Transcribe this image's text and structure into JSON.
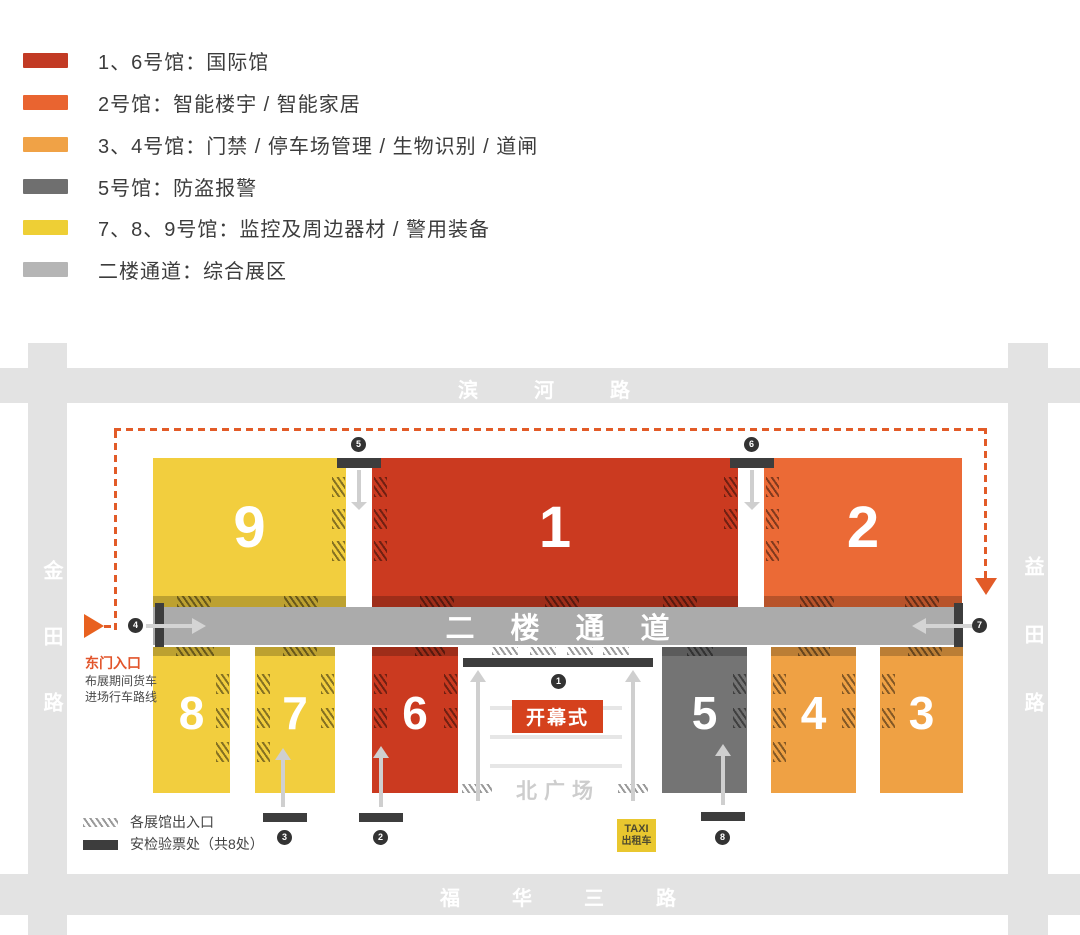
{
  "legend": {
    "items": [
      {
        "label": "1、6号馆：国际馆",
        "color": "#c23a24"
      },
      {
        "label": "2号馆：智能楼宇 / 智能家居",
        "color": "#e96430"
      },
      {
        "label": "3、4号馆：门禁 / 停车场管理 / 生物识别 / 道闸",
        "color": "#f0a246"
      },
      {
        "label": "5号馆：防盗报警",
        "color": "#6f6f6f"
      },
      {
        "label": "7、8、9号馆：监控及周边器材 / 警用装备",
        "color": "#eecf35"
      },
      {
        "label": "二楼通道：综合展区",
        "color": "#b5b5b5"
      }
    ]
  },
  "map": {
    "roads": {
      "top": "滨河路",
      "bottom": "福华三路",
      "left": "金田路",
      "right": "益田路"
    },
    "corridor_label": "二楼通道",
    "halls": [
      {
        "no": "9",
        "color": "#f2ce3e"
      },
      {
        "no": "1",
        "color": "#cb3a20"
      },
      {
        "no": "2",
        "color": "#eb6a36"
      },
      {
        "no": "8",
        "color": "#f2ce3e"
      },
      {
        "no": "7",
        "color": "#f2ce3e"
      },
      {
        "no": "6",
        "color": "#cb3a20"
      },
      {
        "no": "5",
        "color": "#747474"
      },
      {
        "no": "4",
        "color": "#efa144"
      },
      {
        "no": "3",
        "color": "#efa144"
      }
    ],
    "badges": [
      "1",
      "2",
      "3",
      "4",
      "5",
      "6",
      "7",
      "8"
    ],
    "plaza": {
      "label": "北广场",
      "opening": "开幕式",
      "taxi_top": "TAXI",
      "taxi_bottom": "出租车"
    },
    "east_gate": {
      "title": "东门入口",
      "desc1": "布展期间货车",
      "desc2": "进场行车路线"
    },
    "map_legend": {
      "entrance": "各展馆出入口",
      "security": "安检验票处（共8处）"
    }
  },
  "colors": {
    "road": "#e3e3e3",
    "corridor": "#ababab",
    "dashed_route": "#e25b28",
    "security_bar": "#3d3d3d",
    "opening_bg": "#d5411d",
    "taxi_bg": "#e9c72f",
    "east_gate_text": "#e2552b"
  }
}
